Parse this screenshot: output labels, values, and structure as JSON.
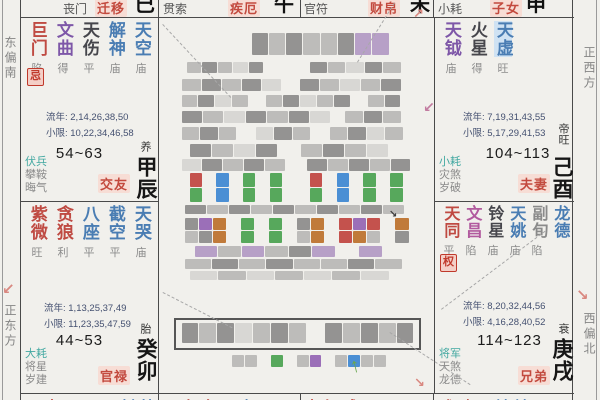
{
  "margins": {
    "left_top": "东偏南",
    "left_bottom": "正东方",
    "right_top": "正西方",
    "right_bottom": "西偏北"
  },
  "top_row": [
    {
      "minor": "丧门",
      "palace": "迁移",
      "branch": "巳"
    },
    {
      "minor": "贯索",
      "palace": "疾厄",
      "branch": "午"
    },
    {
      "minor": "官符",
      "palace": "财帛",
      "branch": "未"
    },
    {
      "minor": "小耗",
      "palace": "子女",
      "branch": "申"
    }
  ],
  "palaces": {
    "chen": {
      "stars": [
        {
          "name": "巨门",
          "status": "陷"
        },
        {
          "name": "文曲",
          "status": "得"
        },
        {
          "name": "天伤",
          "status": "平"
        },
        {
          "name": "解神",
          "status": "庙"
        },
        {
          "name": "天空",
          "status": "庙"
        }
      ],
      "badge": "忌",
      "liunian": "流年: 2,14,26,38,50",
      "xiaoxian": "小限: 10,22,34,46,58",
      "age": "54~63",
      "stage": "养",
      "stem": "甲辰",
      "label": "交友",
      "minors": [
        "伏兵",
        "攀鞍",
        "晦气"
      ]
    },
    "mao": {
      "stars": [
        {
          "name": "紫微",
          "status": "旺"
        },
        {
          "name": "贪狼",
          "status": "利"
        },
        {
          "name": "八座",
          "status": "平"
        },
        {
          "name": "截空",
          "status": "平"
        },
        {
          "name": "天哭",
          "status": "庙"
        }
      ],
      "liunian": "流年: 1,13,25,37,49",
      "xiaoxian": "小限: 11,23,35,47,59",
      "age": "44~53",
      "stage": "胎",
      "stem": "癸卯",
      "label": "官禄",
      "minors": [
        "大耗",
        "将星",
        "岁建"
      ]
    },
    "you": {
      "stars": [
        {
          "name": "天钺",
          "status": "庙"
        },
        {
          "name": "火星",
          "status": "得"
        },
        {
          "name": "天虚",
          "status": "旺"
        }
      ],
      "liunian": "流年: 7,19,31,43,55",
      "xiaoxian": "小限: 5,17,29,41,53",
      "age": "104~113",
      "stage": "帝旺",
      "stem": "己酉",
      "label": "夫妻",
      "minors": [
        "小耗",
        "灾煞",
        "岁破"
      ]
    },
    "xu": {
      "stars": [
        {
          "name": "天同",
          "status": "平"
        },
        {
          "name": "文昌",
          "status": "陷"
        },
        {
          "name": "铃星",
          "status": "庙"
        },
        {
          "name": "天姚",
          "status": "庙"
        },
        {
          "name": "副旬",
          "status": "陷"
        },
        {
          "name": "龙德",
          "status": ""
        }
      ],
      "badge": "权",
      "liunian": "流年: 8,20,32,44,56",
      "xiaoxian": "小限: 4,16,28,40,52",
      "age": "114~123",
      "stage": "衰",
      "stem": "庚戌",
      "label": "兄弟",
      "minors": [
        "将军",
        "天煞",
        "龙德"
      ]
    }
  },
  "bottom_row": [
    {
      "red": "天太",
      "other": "天天天封劫"
    },
    {
      "red": "天左右",
      "other": "天寿"
    },
    {
      "red": "大红咸天",
      "other": ""
    },
    {
      "red": "武破",
      "other": "天地地三天旬"
    }
  ],
  "icons": {
    "arrow_down_left": "↙",
    "arrow_down_right": "↘",
    "arrow_up_right": "↗",
    "arrow_up": "↑"
  },
  "colors": {
    "background": "#f1f0ec",
    "grid_line": "#4a4a4a",
    "major_star_red": "#bf4a42",
    "star_purple": "#7e57a8",
    "star_magenta": "#b15a9e",
    "star_blue": "#4a7db3",
    "star_dark": "#46464c",
    "minor_teal": "#42a8a1",
    "status_gray": "#8c8c8c",
    "palace_label_red": "#c34a3e",
    "palace_label_bg": "#f7ddd5",
    "badge_red": "#c0392b",
    "badge_bg": "#f4cfc7",
    "numbers_navy": "#445070",
    "arrow_pink": "#d98880",
    "arrow_green": "#6aa84f"
  },
  "center": {
    "redacted": true,
    "palette": {
      "g": "#bdbcba",
      "d": "#949392",
      "l": "#d8d7d4",
      "p": "#b7a0c7",
      "G": "#57a85c",
      "B": "#4b8fd4",
      "R": "#c4524d",
      "O": "#c07a3a",
      "P": "#9b6fb8"
    },
    "mosaic": [
      {
        "x": 92,
        "y": 15,
        "w": 138,
        "h": 22,
        "t": "dgdggdpp"
      },
      {
        "x": 27,
        "y": 44,
        "w": 78,
        "h": 11,
        "t": "gdgld"
      },
      {
        "x": 150,
        "y": 44,
        "w": 92,
        "h": 11,
        "t": "dgldg"
      },
      {
        "x": 22,
        "y": 61,
        "w": 100,
        "h": 12,
        "t": "gdgdl"
      },
      {
        "x": 140,
        "y": 61,
        "w": 102,
        "h": 12,
        "t": "dglgd"
      },
      {
        "x": 22,
        "y": 77,
        "w": 220,
        "h": 12,
        "t": "gdlgwgdlgdwgd"
      },
      {
        "x": 22,
        "y": 93,
        "w": 150,
        "h": 12,
        "t": "dgldgdl"
      },
      {
        "x": 185,
        "y": 93,
        "w": 57,
        "h": 12,
        "t": "gdg"
      },
      {
        "x": 22,
        "y": 109,
        "w": 222,
        "h": 13,
        "t": "gdgwldgwgdlg"
      },
      {
        "x": 30,
        "y": 126,
        "w": 200,
        "h": 13,
        "t": "dgldwgdgl"
      },
      {
        "x": 22,
        "y": 141,
        "w": 230,
        "h": 12,
        "t": "ldgdgwdgdgd"
      },
      {
        "x": 30,
        "y": 155,
        "w": 214,
        "h": 14,
        "t": "RwBwGwGwwRwBwGwG"
      },
      {
        "x": 30,
        "y": 170,
        "w": 214,
        "h": 14,
        "t": "GwBwGwGwwGwBwGwG"
      },
      {
        "x": 25,
        "y": 187,
        "w": 220,
        "h": 9,
        "t": "dgdgdgdgdg"
      },
      {
        "x": 25,
        "y": 200,
        "w": 225,
        "h": 12,
        "t": "dPOwGwGwdOwRPRwO"
      },
      {
        "x": 25,
        "y": 213,
        "w": 225,
        "h": 12,
        "t": "gdOwGwGwgOwROgwd"
      },
      {
        "x": 35,
        "y": 228,
        "w": 188,
        "h": 11,
        "t": "pgpgdpwp"
      },
      {
        "x": 25,
        "y": 241,
        "w": 218,
        "h": 10,
        "t": "gdgdggdg"
      },
      {
        "x": 30,
        "y": 253,
        "w": 200,
        "h": 9,
        "t": "lglglgl"
      },
      {
        "x": 22,
        "y": 305,
        "w": 233,
        "h": 20,
        "t": "dgdlgdgwdgdgd"
      },
      {
        "x": 60,
        "y": 337,
        "w": 180,
        "h": 12,
        "t": "wggwGwgPwgBggw"
      }
    ]
  }
}
